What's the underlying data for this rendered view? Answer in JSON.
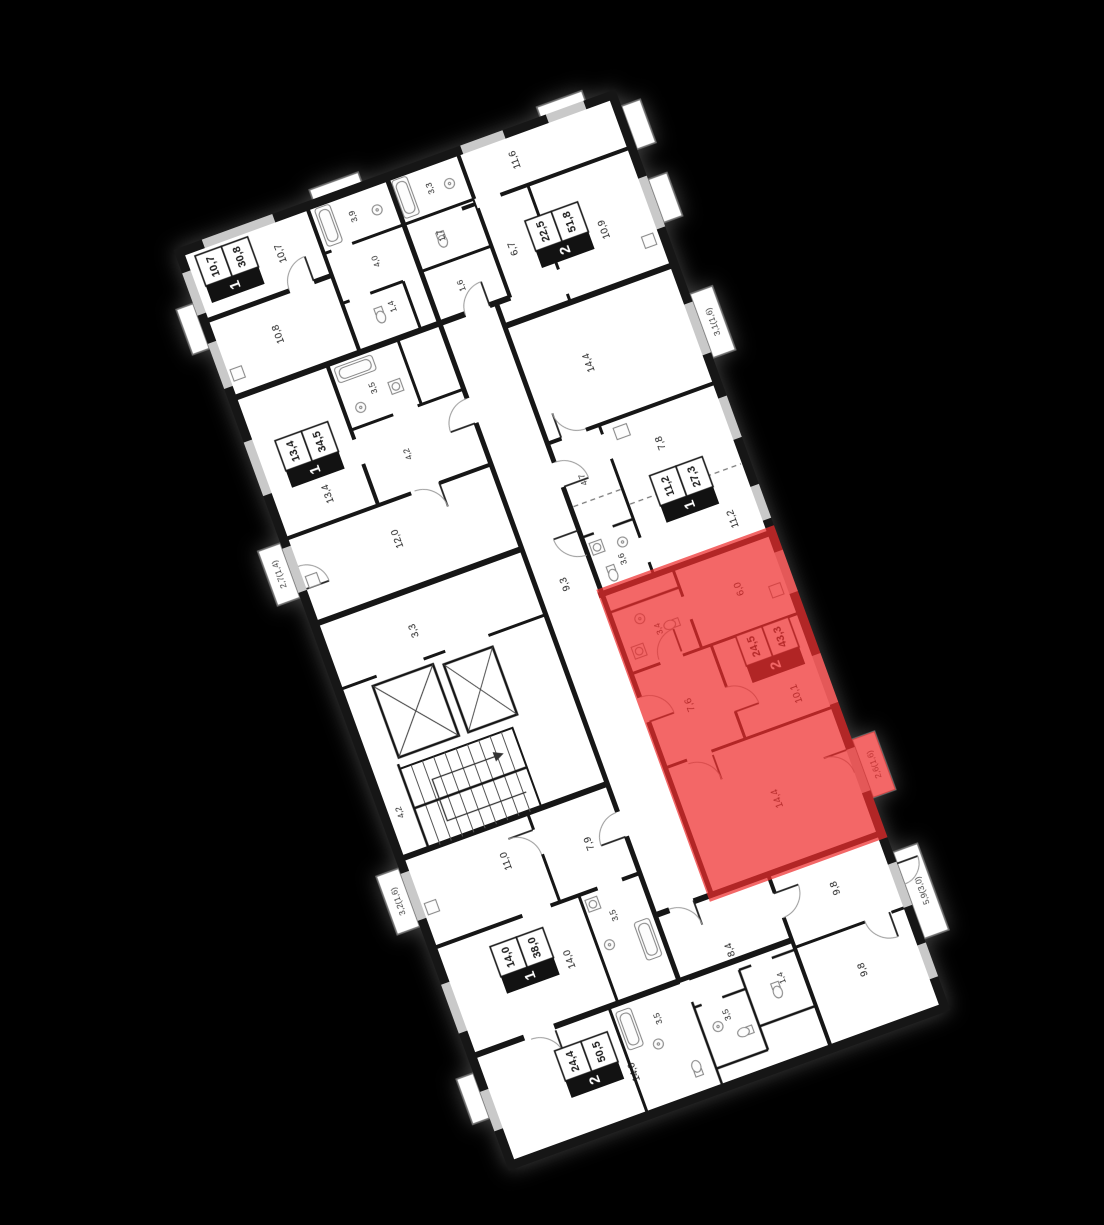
{
  "scene": {
    "background": "#000000",
    "floor_fill": "#ffffff",
    "wall_color": "#161616",
    "window_color": "#c9c9c9",
    "highlight_color": "#ee2c2c"
  },
  "apartments": [
    {
      "id": "apt-1room-top-left",
      "label": {
        "rooms": "1",
        "living": "10,7",
        "total": "30,8"
      },
      "areas": {
        "room": "10,7",
        "kitchen": "10,8",
        "bath": "3,9",
        "hall": "4,0",
        "wc": "1,4"
      }
    },
    {
      "id": "apt-2room-top-right",
      "label": {
        "rooms": "2",
        "living": "22,5",
        "total": "51,8"
      },
      "areas": {
        "room1": "11,6",
        "kitchen": "10,9",
        "room2": "6,7",
        "bath": "3,3",
        "wc": "1,7",
        "hall": "1,6"
      }
    },
    {
      "id": "apt-1room-mid-left",
      "label": {
        "rooms": "1",
        "living": "13,4",
        "total": "34,5"
      },
      "areas": {
        "room": "13,4",
        "bath": "3,5",
        "hall": "4,2",
        "kitchen": "12,0",
        "balcony": "2,7(1,4)"
      }
    },
    {
      "id": "apt-1room-mid-right",
      "label": {
        "rooms": "1",
        "living": "11,2",
        "total": "27,3"
      },
      "areas": {
        "room": "14,4",
        "room2": "7,8",
        "kitchen": "11,2",
        "hall": "4,7",
        "bath": "3,6",
        "balcony": "3,1(1,6)"
      }
    },
    {
      "id": "apt-2room-highlighted",
      "highlighted": true,
      "label": {
        "rooms": "2",
        "living": "24,5",
        "total": "43,3"
      },
      "areas": {
        "kitchen": "6,0",
        "bath": "3,4",
        "room1": "10,1",
        "hall": "7,6",
        "room2": "14,4",
        "balcony": "2,6(1,6)"
      }
    },
    {
      "id": "apt-1room-bottom-left",
      "label": {
        "rooms": "1",
        "living": "14,0",
        "total": "38,0"
      },
      "areas": {
        "kitchen": "11,0",
        "hall": "7,9",
        "room": "14,0",
        "bath": "3,5",
        "balcony": "3,2(1,6)"
      }
    },
    {
      "id": "apt-2room-bottom",
      "label": {
        "rooms": "2",
        "living": "24,4",
        "total": "50,5"
      },
      "areas": {
        "room1": "14,6",
        "hall": "8,4",
        "room2": "9,8",
        "room3": "9,8",
        "bath1": "3,5",
        "bath2": "3,5",
        "wc": "1,4",
        "balcony": "5,9(3,0)"
      }
    }
  ],
  "core": {
    "corridor_main": "9,3",
    "corridor_side": "3,3",
    "shaft": "4,2"
  }
}
